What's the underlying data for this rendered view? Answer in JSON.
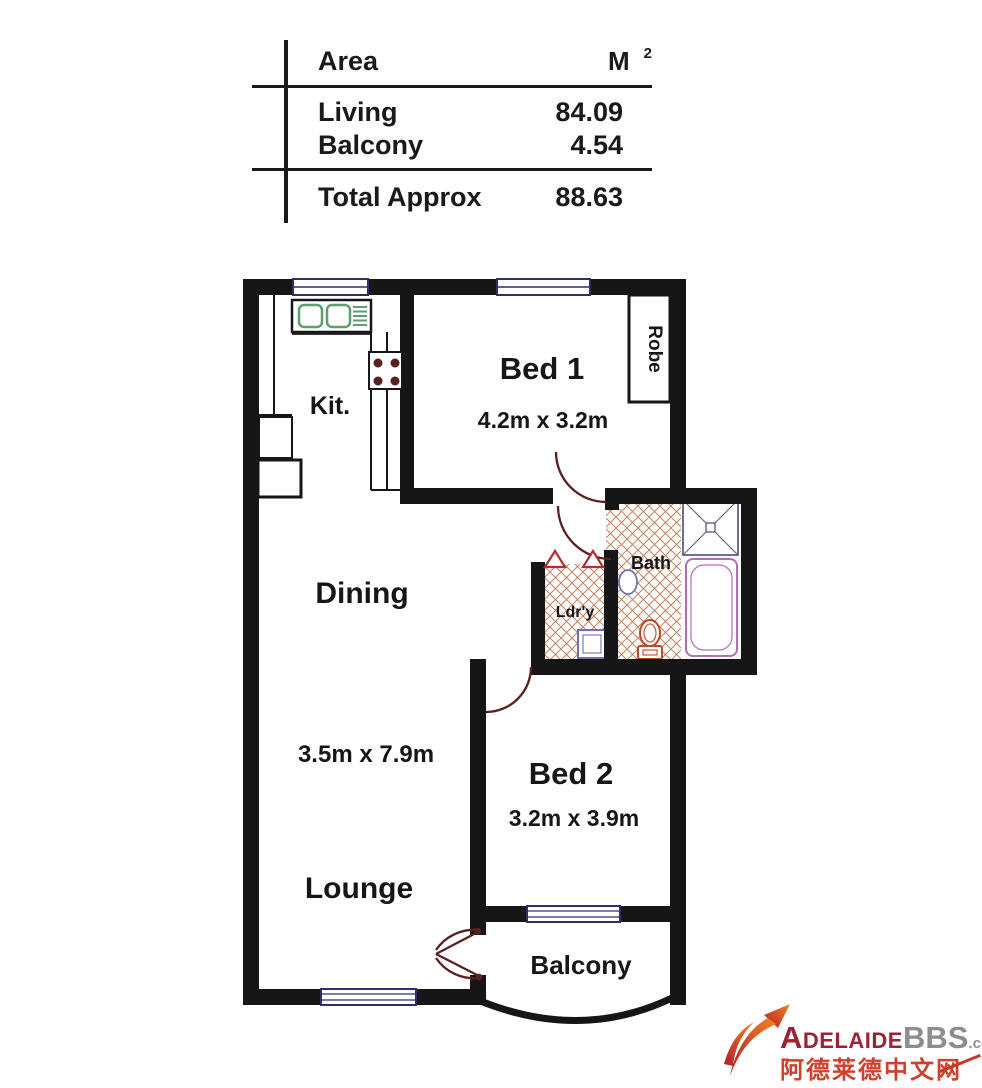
{
  "area_table": {
    "header": {
      "area": "Area",
      "unit": "M",
      "unit_sup": "2"
    },
    "rows": [
      {
        "label": "Living",
        "value": "84.09"
      },
      {
        "label": "Balcony",
        "value": "4.54"
      }
    ],
    "total": {
      "label": "Total Approx",
      "value": "88.63"
    }
  },
  "floorplan": {
    "rooms": {
      "kitchen": {
        "label": "Kit."
      },
      "bed1": {
        "label": "Bed 1",
        "dim": "4.2m x 3.2m"
      },
      "robe": {
        "label": "Robe"
      },
      "dining": {
        "label": "Dining",
        "dim": "3.5m x 7.9m"
      },
      "bath": {
        "label": "Bath"
      },
      "laundry": {
        "label": "Ldr'y"
      },
      "bed2": {
        "label": "Bed 2",
        "dim": "3.2m x 3.9m"
      },
      "lounge": {
        "label": "Lounge"
      },
      "balcony": {
        "label": "Balcony"
      }
    },
    "colors": {
      "wall": "#161616",
      "window_frame": "#2e2e6e",
      "floor_hatch": "#c4825f",
      "door_arc": "#5a1f1f",
      "sink_green": "#5f9f6f",
      "fixture_blue": "#7070b8",
      "fixture_purple": "#b070b0",
      "fixture_red": "#c04a28"
    }
  },
  "watermark": {
    "brand_part1": "Adelaide",
    "brand_part2": "BBS",
    "brand_tld": ".com",
    "chinese_name": "阿德莱德中文网",
    "brand_color": "#9b2335",
    "accent_color": "#d0402a"
  }
}
